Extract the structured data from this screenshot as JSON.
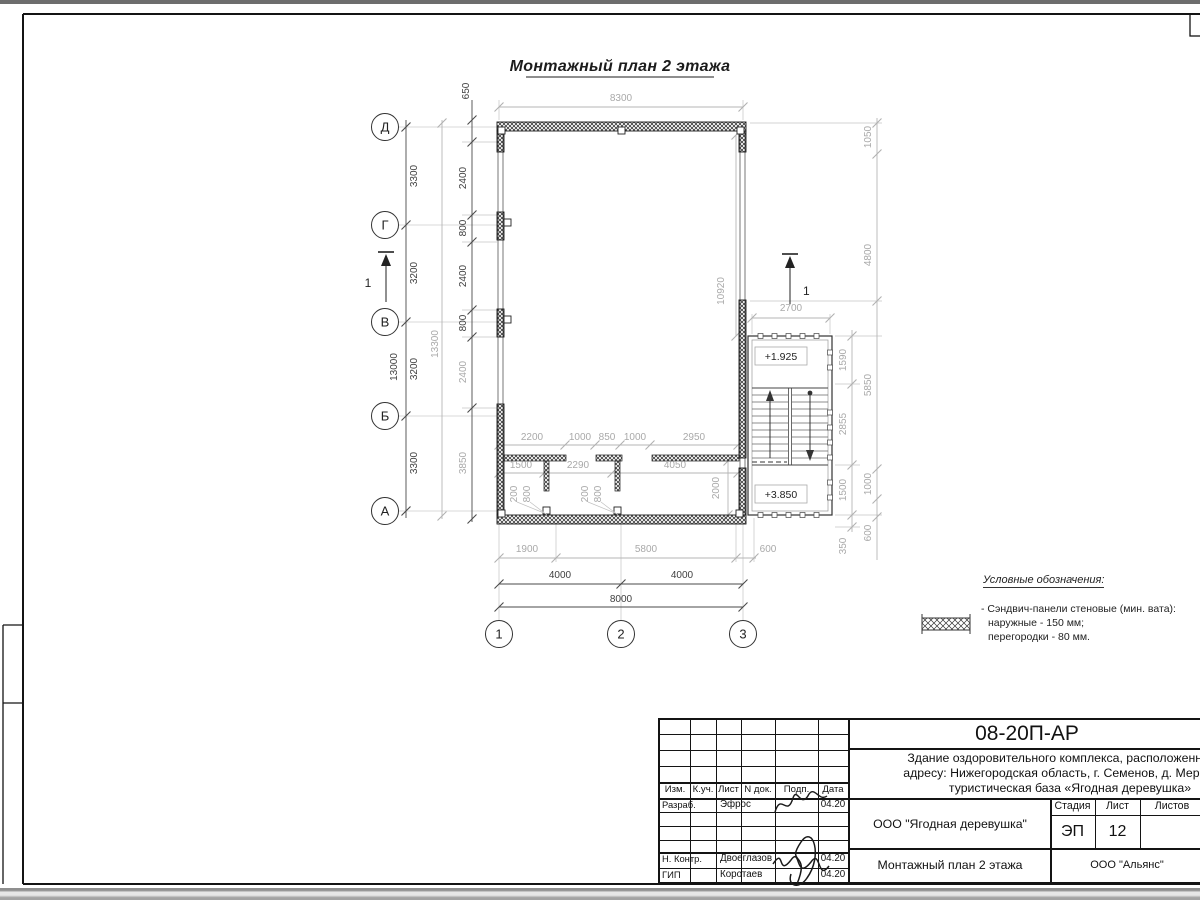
{
  "plan": {
    "title": "Монтажный план 2 этажа",
    "row_axes": [
      "Д",
      "Г",
      "В",
      "Б",
      "А"
    ],
    "col_axes": [
      "1",
      "2",
      "3"
    ],
    "section": "1",
    "dim_top": "8300",
    "dim_650": "650",
    "left_spans": [
      "3300",
      "3200",
      "3200",
      "3300"
    ],
    "left_total": "13000",
    "left_total2": "13300",
    "left_inner": [
      "2400",
      "800",
      "2400",
      "800",
      "2400",
      "3850"
    ],
    "row1": [
      "2200",
      "1000",
      "850",
      "1000",
      "2950"
    ],
    "row2": [
      "1500",
      "2290",
      "4050"
    ],
    "stubs": [
      "200",
      "800",
      "200",
      "800"
    ],
    "dim_10920": "10920",
    "dim_2000": "2000",
    "dim_2700": "2700",
    "stair_spans": [
      "1590",
      "2855",
      "1500",
      "350"
    ],
    "right_spans": [
      "1050",
      "4800",
      "5850",
      "1000",
      "600"
    ],
    "bottom1": [
      "1900",
      "5800",
      "600"
    ],
    "bottom2": [
      "4000",
      "4000"
    ],
    "bottom_total": "8000",
    "elev_upper": "+1.925",
    "elev_lower": "+3.850"
  },
  "legend": {
    "title": "Условные обозначения:",
    "line1": "- Сэндвич-панели стеновые (мин. вата):",
    "line2": "наружные - 150 мм;",
    "line3": "перегородки - 80 мм."
  },
  "titleblock": {
    "code": "08-20П-АР",
    "project1": "Здание оздоровительного комплекса, расположенное по",
    "project2": "адресу: Нижегородская область, г. Семенов, д. Мериново,",
    "project3": "туристическая база «Ягодная деревушка»",
    "headers": [
      "Изм.",
      "К.уч.",
      "Лист",
      "N док.",
      "Подп.",
      "Дата"
    ],
    "row_razrab": {
      "role": "Разраб.",
      "name": "Эфрос",
      "date": "04.20"
    },
    "row_nkontr": {
      "role": "Н. Контр.",
      "name": "Двоеглазов",
      "date": "04.20"
    },
    "row_gip": {
      "role": "ГИП",
      "name": "Коротаев",
      "date": "04.20"
    },
    "object": "ООО \"Ягодная деревушка\"",
    "sheet_title": "Монтажный план 2 этажа",
    "stage_label": "Стадия",
    "list_label": "Лист",
    "listov_label": "Листов",
    "stage": "ЭП",
    "sheet_no": "12",
    "company": "ООО \"Альянс\""
  }
}
